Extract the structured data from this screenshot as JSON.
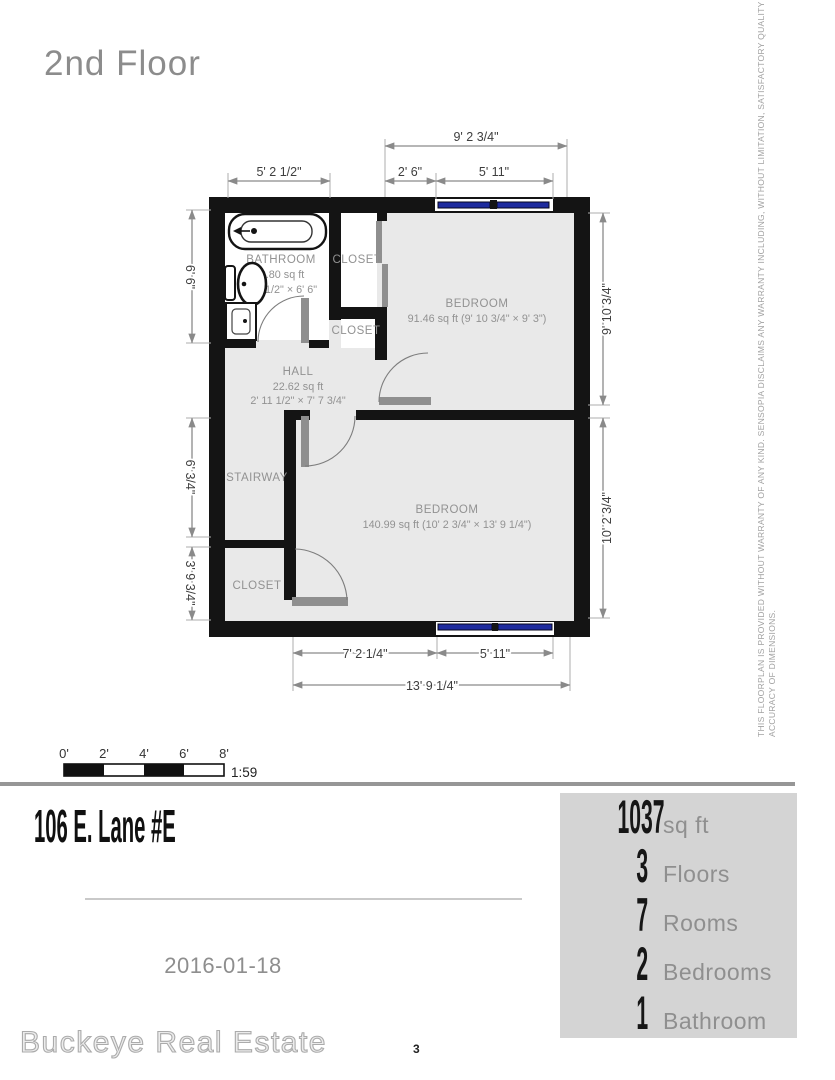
{
  "page": {
    "title": "2nd Floor",
    "page_number": "3",
    "date": "2016-01-18",
    "address": "106 E. Lane #E",
    "brand": "Buckeye Real Estate",
    "disclaimer_line1": "THIS FLOORPLAN IS PROVIDED WITHOUT WARRANTY OF ANY KIND. SENSOPIA DISCLAIMS ANY WARRANTY INCLUDING, WITHOUT LIMITATION, SATISFACTORY QUALITY OR",
    "disclaimer_line2": "ACCURACY OF DIMENSIONS."
  },
  "plan": {
    "rooms": {
      "bathroom": {
        "name": "BATHROOM",
        "area": "33.80 sq ft",
        "dims": "5' 2 1/2\" × 6' 6\""
      },
      "closet_top": {
        "name": "CLOSET"
      },
      "closet_mid": {
        "name": "CLOSET"
      },
      "closet_lower": {
        "name": "CLOSET"
      },
      "hall": {
        "name": "HALL",
        "area": "22.62 sq ft",
        "dims": "2' 11 1/2\" × 7' 7 3/4\""
      },
      "stairway": {
        "name": "STAIRWAY"
      },
      "bedroom_top": {
        "name": "BEDROOM",
        "area": "91.46 sq ft (9' 10 3/4\" × 9' 3\")"
      },
      "bedroom_bottom": {
        "name": "BEDROOM",
        "area": "140.99 sq ft (10' 2 3/4\" × 13' 9 1/4\")"
      }
    },
    "dims": {
      "top_bedroom": "9' 2 3/4\"",
      "top_bathroom": "5' 2 1/2\"",
      "top_gap": "2' 6\"",
      "top_window": "5' 11\"",
      "left_bathroom": "6' 6\"",
      "left_stairway": "6' 3/4\"",
      "left_closet": "3' 9 3/4\"",
      "right_bedroom_top": "9' 10 3/4\"",
      "right_bedroom_bottom": "10' 2 3/4\"",
      "bottom_left": "7' 2 1/4\"",
      "bottom_window": "5' 11\"",
      "bottom_total": "13' 9 1/4\""
    }
  },
  "scale_bar": {
    "tick0": "0'",
    "tick2": "2'",
    "tick4": "4'",
    "tick6": "6'",
    "tick8": "8'",
    "ratio": "1:59"
  },
  "stats": {
    "rows": [
      {
        "value": "1037",
        "label": "sq ft"
      },
      {
        "value": "3",
        "label": "Floors"
      },
      {
        "value": "7",
        "label": "Rooms"
      },
      {
        "value": "2",
        "label": "Bedrooms"
      },
      {
        "value": "1",
        "label": "Bathroom"
      }
    ]
  },
  "colors": {
    "window_blue": "#1e2b9e",
    "stats_box_bg": "#d4d4d4",
    "wall_black": "#141414"
  }
}
